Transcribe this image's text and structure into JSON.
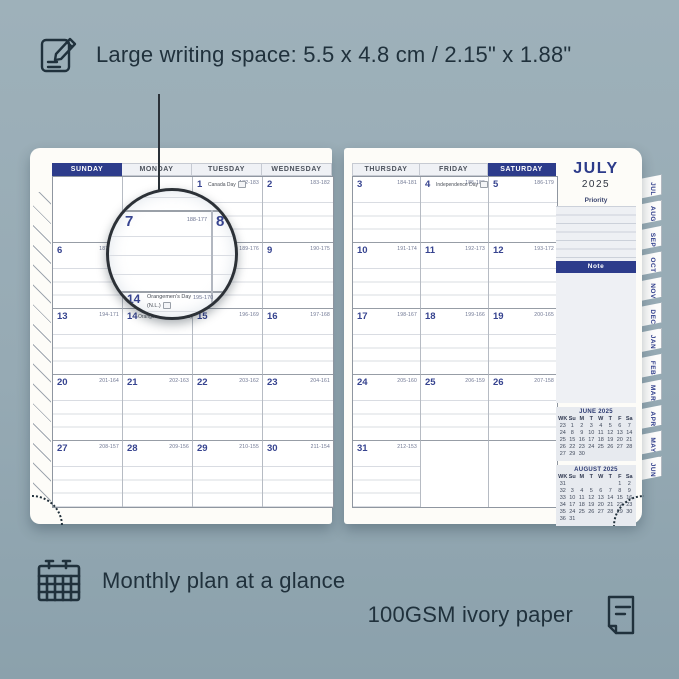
{
  "annotations": {
    "top": {
      "icon": "pencil-note-icon",
      "text": "Large writing space: 5.5 x 4.8 cm / 2.15\" x 1.88\""
    },
    "bottom_left": {
      "icon": "calendar-grid-icon",
      "text": "Monthly plan at a glance"
    },
    "bottom_right": {
      "icon": "paper-icon",
      "text": "100GSM ivory paper"
    }
  },
  "planner": {
    "month_title": "JULY",
    "year": "2025",
    "left_page": {
      "headers": [
        "SUNDAY",
        "MONDAY",
        "TUESDAY",
        "WEDNESDAY"
      ],
      "highlighted_header": "SUNDAY",
      "rows": [
        [
          null,
          null,
          {
            "day": "1",
            "count": "182-183",
            "holiday": "Canada Day"
          },
          {
            "day": "2",
            "count": "183-182"
          }
        ],
        [
          {
            "day": "6",
            "count": "187-178"
          },
          {
            "day": "7",
            "count": "188-177"
          },
          {
            "day": "8",
            "count": "189-176"
          },
          {
            "day": "9",
            "count": "190-175"
          }
        ],
        [
          {
            "day": "13",
            "count": "194-171"
          },
          {
            "day": "14",
            "count": "195-170",
            "holiday": "Orangemen's Day (N.L.)"
          },
          {
            "day": "15",
            "count": "196-169"
          },
          {
            "day": "16",
            "count": "197-168"
          }
        ],
        [
          {
            "day": "20",
            "count": "201-164"
          },
          {
            "day": "21",
            "count": "202-163"
          },
          {
            "day": "22",
            "count": "203-162"
          },
          {
            "day": "23",
            "count": "204-161"
          }
        ],
        [
          {
            "day": "27",
            "count": "208-157"
          },
          {
            "day": "28",
            "count": "209-156"
          },
          {
            "day": "29",
            "count": "210-155"
          },
          {
            "day": "30",
            "count": "211-154"
          }
        ]
      ]
    },
    "right_page": {
      "headers": [
        "THURSDAY",
        "FRIDAY",
        "SATURDAY"
      ],
      "highlighted_header": "SATURDAY",
      "rows": [
        [
          {
            "day": "3",
            "count": "184-181"
          },
          {
            "day": "4",
            "count": "185-180",
            "holiday": "Independence Day"
          },
          {
            "day": "5",
            "count": "186-179"
          }
        ],
        [
          {
            "day": "10",
            "count": "191-174"
          },
          {
            "day": "11",
            "count": "192-173"
          },
          {
            "day": "12",
            "count": "193-172"
          }
        ],
        [
          {
            "day": "17",
            "count": "198-167"
          },
          {
            "day": "18",
            "count": "199-166"
          },
          {
            "day": "19",
            "count": "200-165"
          }
        ],
        [
          {
            "day": "24",
            "count": "205-160"
          },
          {
            "day": "25",
            "count": "206-159"
          },
          {
            "day": "26",
            "count": "207-158"
          }
        ],
        [
          {
            "day": "31",
            "count": "212-153"
          },
          null,
          null
        ]
      ]
    },
    "sidebar": {
      "priority_label": "Priority",
      "note_label": "Note",
      "mini_calendars": [
        {
          "title": "JUNE 2025",
          "cols": [
            "WK",
            "Su",
            "M",
            "T",
            "W",
            "T",
            "F",
            "Sa"
          ],
          "weeks": [
            [
              "23",
              "1",
              "2",
              "3",
              "4",
              "5",
              "6",
              "7"
            ],
            [
              "24",
              "8",
              "9",
              "10",
              "11",
              "12",
              "13",
              "14"
            ],
            [
              "25",
              "15",
              "16",
              "17",
              "18",
              "19",
              "20",
              "21"
            ],
            [
              "26",
              "22",
              "23",
              "24",
              "25",
              "26",
              "27",
              "28"
            ],
            [
              "27",
              "29",
              "30",
              "",
              "",
              "",
              "",
              ""
            ]
          ]
        },
        {
          "title": "AUGUST 2025",
          "cols": [
            "WK",
            "Su",
            "M",
            "T",
            "W",
            "T",
            "F",
            "Sa"
          ],
          "weeks": [
            [
              "31",
              "",
              "",
              "",
              "",
              "",
              "1",
              "2"
            ],
            [
              "32",
              "3",
              "4",
              "5",
              "6",
              "7",
              "8",
              "9"
            ],
            [
              "33",
              "10",
              "11",
              "12",
              "13",
              "14",
              "15",
              "16"
            ],
            [
              "34",
              "17",
              "18",
              "19",
              "20",
              "21",
              "22",
              "23"
            ],
            [
              "35",
              "24",
              "25",
              "26",
              "27",
              "28",
              "29",
              "30"
            ],
            [
              "36",
              "31",
              "",
              "",
              "",
              "",
              "",
              ""
            ]
          ]
        }
      ]
    },
    "tabs": [
      "JUL",
      "AUG",
      "SEP",
      "OCT",
      "NOV",
      "DEC",
      "JAN",
      "FEB",
      "MAR",
      "APR",
      "MAY",
      "JUN"
    ]
  },
  "magnifier": {
    "day_left": "7",
    "count_left": "188-177",
    "day_right": "8",
    "day_bottom": "14",
    "holiday_bottom": "Orangemen's Day",
    "holiday_region": "(N.L.)",
    "count_bottom": "195-170"
  },
  "colors": {
    "background": "#96aab4",
    "navy_accent": "#2d3c8b",
    "ink": "#20313c",
    "page": "#fdfcf8"
  }
}
